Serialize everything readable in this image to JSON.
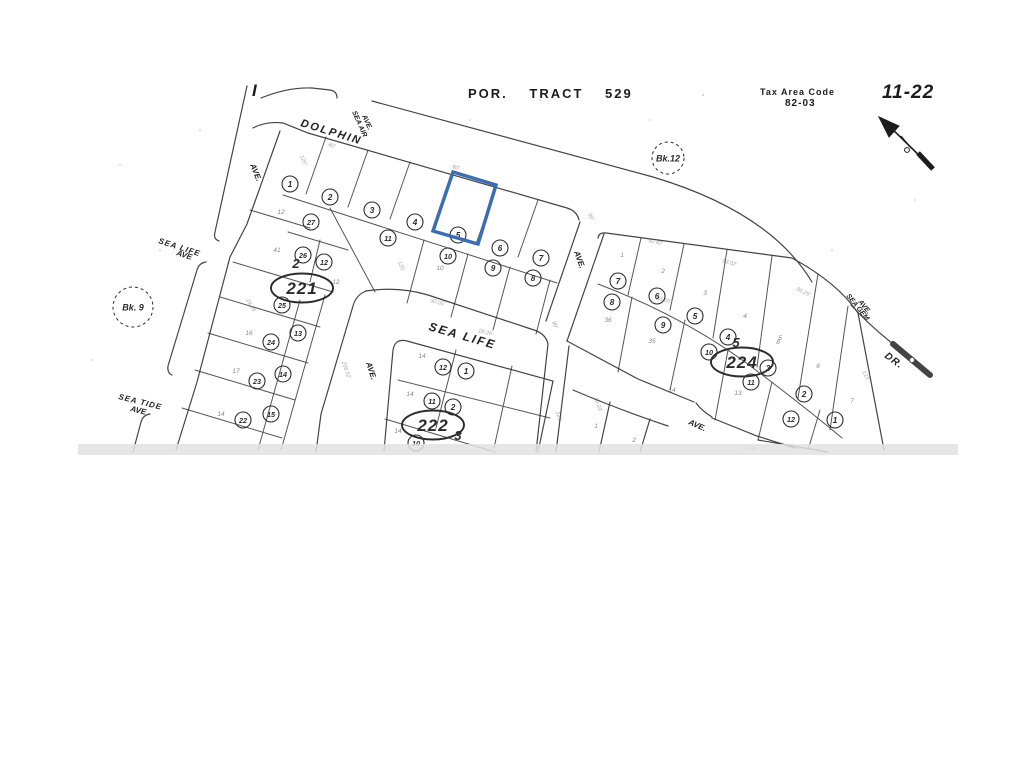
{
  "header": {
    "title": "POR. TRACT 529",
    "tax_area_code_label": "Tax Area Code",
    "tax_area_code_value": "82-03",
    "sheet_number": "11-22",
    "edge_mark": "I"
  },
  "colors": {
    "ink": "#2b2b2b",
    "faint": "#555555",
    "highlight": "#3c6cb4",
    "scan_band": "#e2e2e2"
  },
  "book_references": [
    {
      "label": "Bk.12",
      "x": 668,
      "y": 158,
      "r": 16
    },
    {
      "label": "Bk. 9",
      "x": 133,
      "y": 307,
      "r": 20
    }
  ],
  "block_ovals": [
    {
      "number": "221",
      "x": 302,
      "y": 288,
      "prefix": "2",
      "px": 296,
      "py": 268
    },
    {
      "number": "222",
      "x": 433,
      "y": 425,
      "prefix": "3",
      "px": 458,
      "py": 440
    },
    {
      "number": "224",
      "x": 742,
      "y": 362,
      "prefix": "5",
      "px": 736,
      "py": 347
    }
  ],
  "street_labels": [
    {
      "text": "DOLPHIN",
      "x": 300,
      "y": 126,
      "rot": 17,
      "size": 11,
      "weight": "bold",
      "italic": true,
      "spacing": 2
    },
    {
      "text": "SEA AIR",
      "x": 352,
      "y": 112,
      "rot": 66,
      "size": 7,
      "weight": "bold",
      "italic": true,
      "spacing": 0
    },
    {
      "text": "AVE.",
      "x": 362,
      "y": 116,
      "rot": 66,
      "size": 7,
      "weight": "bold",
      "italic": true,
      "spacing": 0
    },
    {
      "text": "AVE.",
      "x": 250,
      "y": 165,
      "rot": 68,
      "size": 8,
      "weight": "bold",
      "italic": true,
      "spacing": 0
    },
    {
      "text": "SEA LIFE",
      "x": 158,
      "y": 243,
      "rot": 18,
      "size": 8,
      "weight": "bold",
      "italic": true,
      "spacing": 1
    },
    {
      "text": "AVE",
      "x": 176,
      "y": 255,
      "rot": 18,
      "size": 8,
      "weight": "bold",
      "italic": true,
      "spacing": 0
    },
    {
      "text": "SEA TIDE",
      "x": 118,
      "y": 399,
      "rot": 14,
      "size": 8,
      "weight": "bold",
      "italic": true,
      "spacing": 1
    },
    {
      "text": "AVE",
      "x": 130,
      "y": 411,
      "rot": 14,
      "size": 8,
      "weight": "bold",
      "italic": true,
      "spacing": 0
    },
    {
      "text": "SEA  LIFE",
      "x": 428,
      "y": 330,
      "rot": 16,
      "size": 12,
      "weight": "bold",
      "italic": true,
      "spacing": 2
    },
    {
      "text": "AVE.",
      "x": 366,
      "y": 363,
      "rot": 72,
      "size": 8,
      "weight": "bold",
      "italic": true,
      "spacing": 0
    },
    {
      "text": "AVE.",
      "x": 574,
      "y": 252,
      "rot": 70,
      "size": 8,
      "weight": "bold",
      "italic": true,
      "spacing": 0
    },
    {
      "text": "SEA GEM",
      "x": 846,
      "y": 296,
      "rot": 51,
      "size": 7,
      "weight": "bold",
      "italic": true,
      "spacing": 0
    },
    {
      "text": "AVE.",
      "x": 858,
      "y": 302,
      "rot": 51,
      "size": 7,
      "weight": "bold",
      "italic": true,
      "spacing": 0
    },
    {
      "text": "DR.",
      "x": 884,
      "y": 357,
      "rot": 36,
      "size": 10,
      "weight": "bold",
      "italic": true,
      "spacing": 1
    },
    {
      "text": "AVE.",
      "x": 688,
      "y": 424,
      "rot": 24,
      "size": 8,
      "weight": "bold",
      "italic": true,
      "spacing": 0
    }
  ],
  "circled_parcels": [
    {
      "n": "1",
      "x": 290,
      "y": 184
    },
    {
      "n": "2",
      "x": 330,
      "y": 197
    },
    {
      "n": "3",
      "x": 372,
      "y": 210
    },
    {
      "n": "4",
      "x": 415,
      "y": 222
    },
    {
      "n": "5",
      "x": 458,
      "y": 235
    },
    {
      "n": "6",
      "x": 500,
      "y": 248
    },
    {
      "n": "7",
      "x": 541,
      "y": 258
    },
    {
      "n": "27",
      "x": 311,
      "y": 222
    },
    {
      "n": "26",
      "x": 303,
      "y": 255
    },
    {
      "n": "12",
      "x": 324,
      "y": 262
    },
    {
      "n": "11",
      "x": 388,
      "y": 238
    },
    {
      "n": "10",
      "x": 448,
      "y": 256
    },
    {
      "n": "9",
      "x": 493,
      "y": 268
    },
    {
      "n": "8",
      "x": 533,
      "y": 278
    },
    {
      "n": "25",
      "x": 282,
      "y": 305
    },
    {
      "n": "13",
      "x": 298,
      "y": 333
    },
    {
      "n": "24",
      "x": 271,
      "y": 342
    },
    {
      "n": "14",
      "x": 283,
      "y": 374
    },
    {
      "n": "23",
      "x": 257,
      "y": 381
    },
    {
      "n": "15",
      "x": 271,
      "y": 414
    },
    {
      "n": "22",
      "x": 243,
      "y": 420
    },
    {
      "n": "12",
      "x": 443,
      "y": 367
    },
    {
      "n": "1",
      "x": 466,
      "y": 371
    },
    {
      "n": "11",
      "x": 432,
      "y": 401
    },
    {
      "n": "2",
      "x": 453,
      "y": 407
    },
    {
      "n": "10",
      "x": 416,
      "y": 443
    },
    {
      "n": "7",
      "x": 618,
      "y": 281
    },
    {
      "n": "6",
      "x": 657,
      "y": 296
    },
    {
      "n": "8",
      "x": 612,
      "y": 302
    },
    {
      "n": "5",
      "x": 695,
      "y": 316
    },
    {
      "n": "9",
      "x": 663,
      "y": 325
    },
    {
      "n": "4",
      "x": 728,
      "y": 337
    },
    {
      "n": "10",
      "x": 709,
      "y": 352
    },
    {
      "n": "3",
      "x": 768,
      "y": 368
    },
    {
      "n": "11",
      "x": 751,
      "y": 382
    },
    {
      "n": "2",
      "x": 804,
      "y": 394
    },
    {
      "n": "12",
      "x": 791,
      "y": 419
    },
    {
      "n": "1",
      "x": 835,
      "y": 420
    }
  ],
  "plain_lot_numbers": [
    {
      "n": "12",
      "x": 281,
      "y": 214
    },
    {
      "n": "41",
      "x": 277,
      "y": 252
    },
    {
      "n": "12",
      "x": 336,
      "y": 284
    },
    {
      "n": "16",
      "x": 249,
      "y": 335
    },
    {
      "n": "17",
      "x": 236,
      "y": 373
    },
    {
      "n": "14",
      "x": 221,
      "y": 416
    },
    {
      "n": "10",
      "x": 440,
      "y": 270
    },
    {
      "n": "14",
      "x": 422,
      "y": 358
    },
    {
      "n": "14",
      "x": 410,
      "y": 396
    },
    {
      "n": "14",
      "x": 398,
      "y": 433
    },
    {
      "n": "1",
      "x": 596,
      "y": 428
    },
    {
      "n": "2",
      "x": 634,
      "y": 442
    },
    {
      "n": "1",
      "x": 622,
      "y": 257
    },
    {
      "n": "2",
      "x": 663,
      "y": 273
    },
    {
      "n": "3",
      "x": 705,
      "y": 295
    },
    {
      "n": "4",
      "x": 745,
      "y": 318
    },
    {
      "n": "5",
      "x": 780,
      "y": 340
    },
    {
      "n": "36",
      "x": 608,
      "y": 322
    },
    {
      "n": "35",
      "x": 652,
      "y": 343
    },
    {
      "n": "13",
      "x": 738,
      "y": 395
    },
    {
      "n": "8",
      "x": 778,
      "y": 344
    },
    {
      "n": "6",
      "x": 818,
      "y": 368
    },
    {
      "n": "7",
      "x": 852,
      "y": 403
    },
    {
      "n": "14",
      "x": 672,
      "y": 392
    }
  ],
  "dimension_texts": [
    {
      "t": "125'",
      "x": 300,
      "y": 156,
      "r": 68
    },
    {
      "t": "60'",
      "x": 452,
      "y": 168,
      "r": 17
    },
    {
      "t": "60'",
      "x": 328,
      "y": 146,
      "r": 17
    },
    {
      "t": "80'",
      "x": 588,
      "y": 214,
      "r": 68
    },
    {
      "t": "92.42'",
      "x": 648,
      "y": 242,
      "r": 12
    },
    {
      "t": "93.02'",
      "x": 722,
      "y": 262,
      "r": 16
    },
    {
      "t": "95.25'",
      "x": 796,
      "y": 290,
      "r": 26
    },
    {
      "t": "125'",
      "x": 398,
      "y": 262,
      "r": 68
    },
    {
      "t": "29.26'",
      "x": 478,
      "y": 332,
      "r": 15
    },
    {
      "t": "30.05'",
      "x": 430,
      "y": 302,
      "r": 15
    },
    {
      "t": "206.92'",
      "x": 342,
      "y": 362,
      "r": 72
    },
    {
      "t": "125'",
      "x": 556,
      "y": 412,
      "r": 74
    },
    {
      "t": "84.65'",
      "x": 656,
      "y": 300,
      "r": 12
    },
    {
      "t": "29.26'",
      "x": 246,
      "y": 300,
      "r": 60
    },
    {
      "t": "80'",
      "x": 552,
      "y": 322,
      "r": 68
    },
    {
      "t": "123'",
      "x": 862,
      "y": 372,
      "r": 60
    },
    {
      "t": "24.88'",
      "x": 742,
      "y": 448,
      "r": 12
    },
    {
      "t": "30.03'",
      "x": 594,
      "y": 398,
      "r": 70
    }
  ],
  "highlighted_parcel": {
    "number": "5",
    "points": "453,172 496,185 478,244 433,231"
  }
}
